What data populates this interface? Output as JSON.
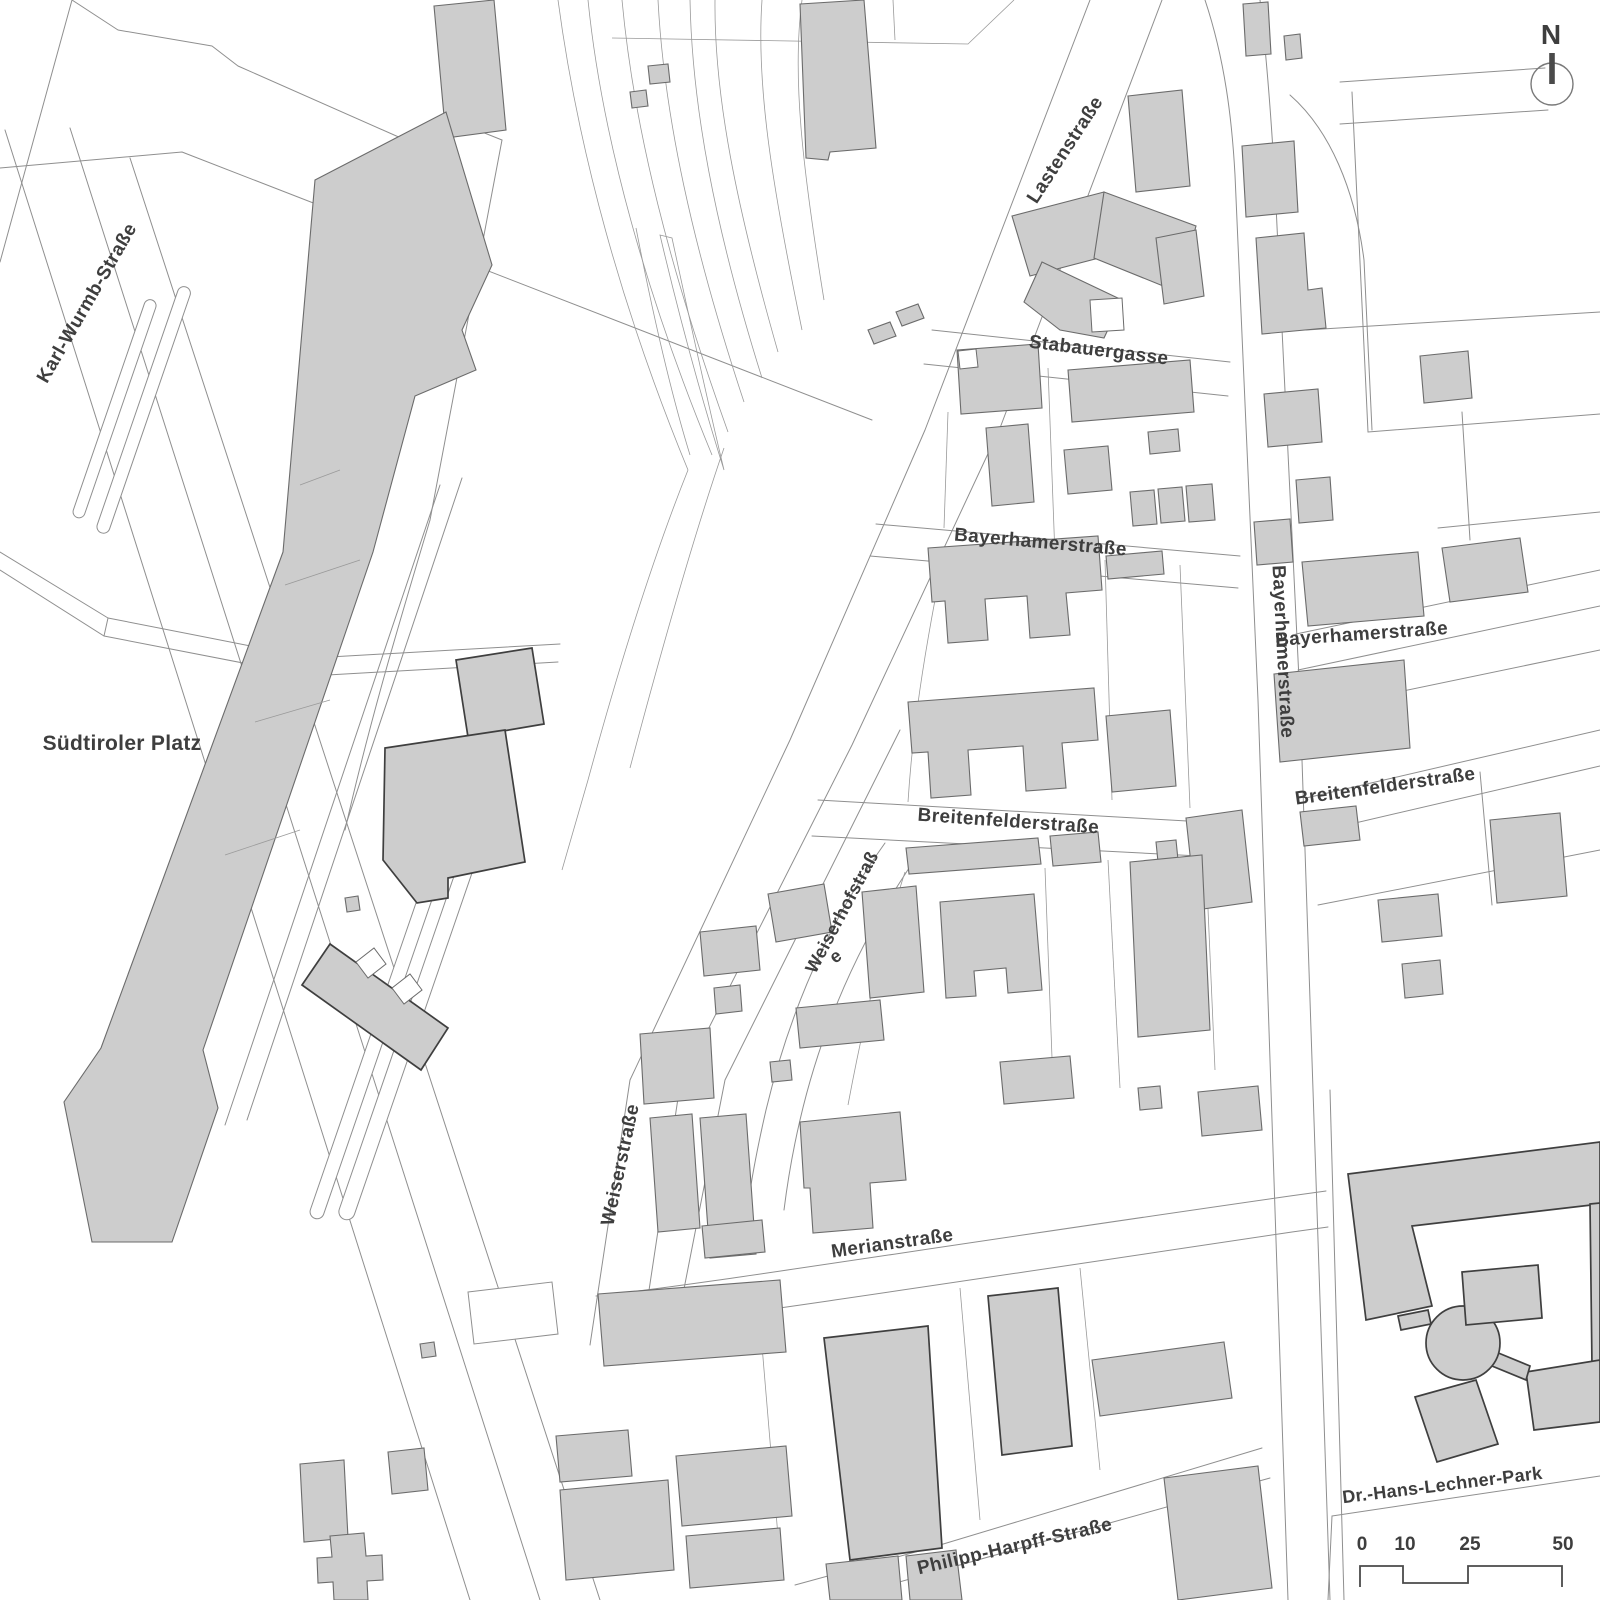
{
  "map": {
    "type": "cadastral-site-plan",
    "labels": [
      {
        "id": "karl-wurmb-strasse",
        "text": "Karl-Wurmb-Straße"
      },
      {
        "id": "suedtiroler-platz",
        "text": "Südtiroler Platz"
      },
      {
        "id": "lastenstrasse",
        "text": "Lastenstraße"
      },
      {
        "id": "stabauergasse",
        "text": "Stabauergasse"
      },
      {
        "id": "bayerhamerstrasse-center",
        "text": "Bayerhamerstraße"
      },
      {
        "id": "bayerhamerstrasse-main",
        "text": "Bayerhamerstraße"
      },
      {
        "id": "bayerhamerstrasse-east",
        "text": "Bayerhamerstraße"
      },
      {
        "id": "breitenfelderstrasse-center",
        "text": "Breitenfelderstraße"
      },
      {
        "id": "breitenfelderstrasse-east",
        "text": "Breitenfelderstraße"
      },
      {
        "id": "weiserhofstrasse",
        "text": "Weiserhofstraß"
      },
      {
        "id": "weiserhofstrasse-e",
        "text": "e"
      },
      {
        "id": "weiserstrasse",
        "text": "Weiserstraße"
      },
      {
        "id": "merianstrasse",
        "text": "Merianstraße"
      },
      {
        "id": "philipp-harpff-strasse",
        "text": "Philipp-Harpff-Straße"
      },
      {
        "id": "dr-hans-lechner-park",
        "text": "Dr.-Hans-Lechner-Park"
      }
    ],
    "compass": {
      "label": "N"
    },
    "scale_bar": {
      "ticks": [
        "0",
        "10",
        "25",
        "50"
      ]
    },
    "colors": {
      "building_fill": "#cdcdcd",
      "building_stroke": "#6b6b6b",
      "emphasis_stroke": "#3f3f3f",
      "parcel_line": "#8f8f8f",
      "label_color": "#3e3e3e",
      "background": "#ffffff"
    }
  }
}
